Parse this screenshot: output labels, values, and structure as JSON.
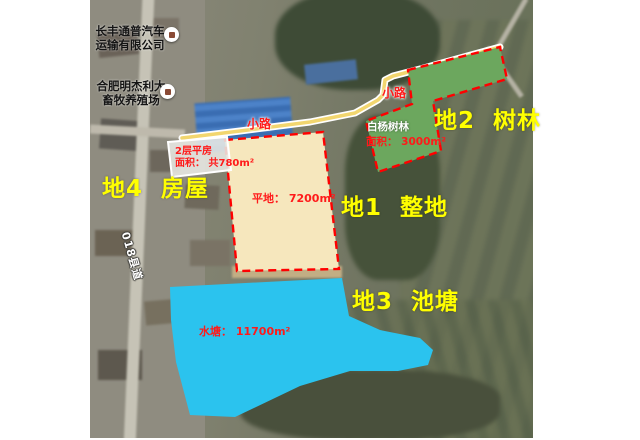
{
  "window": {
    "width": 640,
    "height": 440,
    "background": "#ffffff"
  },
  "map": {
    "type": "satellite-annotation",
    "pois": {
      "company": {
        "line1": "长丰通普汽车",
        "line2": "运输有限公司",
        "marker_icon": "poi-dot"
      },
      "farm": {
        "line1": "合肥明杰利大",
        "line2": "畜牧养殖场",
        "marker_icon": "poi-dot"
      }
    },
    "road_name": "018县道",
    "trail_labels": {
      "first": "小路",
      "second": "小路"
    }
  },
  "parcels": {
    "parcel1": {
      "title": "地1  整地",
      "area": "平地： 7200m²",
      "fill": "#f6e7bd",
      "border": "#ff0000"
    },
    "parcel2": {
      "title": "地2  树林",
      "name": "白杨树林",
      "area": "面积： 3000m²",
      "fill": "#6ca75e",
      "border": "#ff0000"
    },
    "parcel3": {
      "title": "地3  池塘",
      "area": "水塘： 11700m²",
      "fill": "#2bc3ee"
    },
    "parcel4": {
      "title": "地4  房屋",
      "building": "2层平房",
      "area": "面积： 共780m²",
      "fill": "#e9e9e4",
      "border": "#ffffff"
    }
  },
  "colors": {
    "title_text": "#ffff00",
    "annotation_text": "#ff1a1a",
    "trail": "#f2d66f",
    "trail_casing": "#ffffff"
  }
}
